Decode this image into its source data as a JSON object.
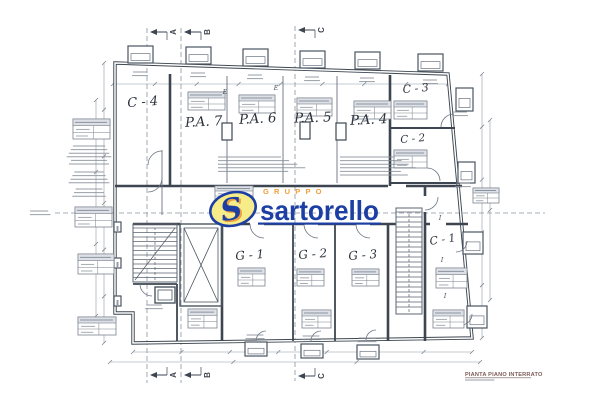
{
  "logo": {
    "group_label": "GRUPPO",
    "name": "sartorello",
    "s_initial": "S",
    "blue": "#1d3fa3",
    "orange": "#ef9f3b",
    "yellow": "#f6ec8a"
  },
  "rooms": [
    {
      "label": "C - 4"
    },
    {
      "label": "P.A. 7"
    },
    {
      "label": "P.A. 6"
    },
    {
      "label": "P.A. 5"
    },
    {
      "label": "P.A. 4"
    },
    {
      "label": "C - 3"
    },
    {
      "label": "C - 2"
    },
    {
      "label": "C - 1"
    },
    {
      "label": "G - 1"
    },
    {
      "label": "G - 2"
    },
    {
      "label": "G - 3"
    }
  ],
  "section_markers": {
    "top": [
      "A",
      "B",
      "C"
    ],
    "bottom": [
      "A",
      "B",
      "C"
    ]
  },
  "marks": {
    "bay": [
      "E",
      "E"
    ],
    "columns": [
      "I",
      "I",
      "I"
    ]
  },
  "footer": {
    "title": "PIANTA PIANO INTERRATO"
  }
}
